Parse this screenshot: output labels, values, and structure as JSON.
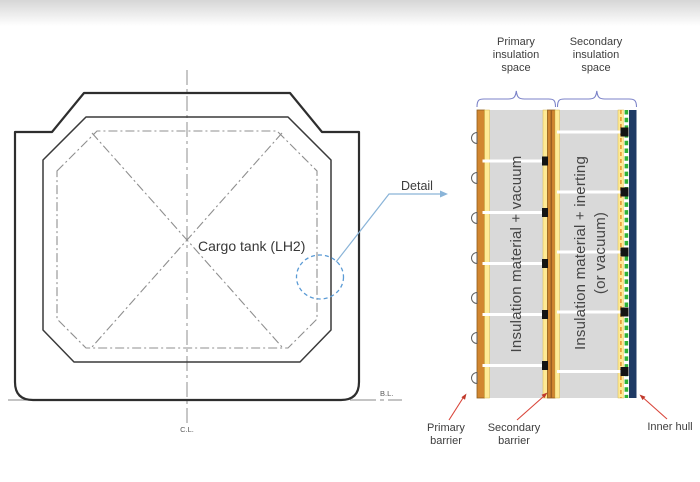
{
  "hull": {
    "tank_label": "Cargo tank (LH2)",
    "detail_label": "Detail",
    "centerline_label": "C.L.",
    "baseline_label": "B.L."
  },
  "detail": {
    "primary_space": {
      "lines": [
        "Primary",
        "insulation",
        "space"
      ]
    },
    "secondary_space": {
      "lines": [
        "Secondary",
        "insulation",
        "space"
      ]
    },
    "primary_fill_text": "Insulation material + vacuum",
    "secondary_fill_text_1": "Insulation material + inerting",
    "secondary_fill_text_2": "(or vacuum)",
    "primary_barrier": {
      "lines": [
        "Primary",
        "barrier"
      ]
    },
    "secondary_barrier": {
      "lines": [
        "Secondary",
        "barrier"
      ]
    },
    "inner_hull_label": "Inner hull"
  },
  "colors": {
    "insulation_gray": "#d9d9d9",
    "barrier_orange": "#d1862f",
    "barrier_yellow": "#ffea96",
    "barrier_dark_edge": "#8f5c1d",
    "inner_hull_navy": "#1e3a64",
    "membrane_green": "#2eb135",
    "membrane_orange_dash": "#e59a33",
    "callout_red": "#d9453a",
    "brace_blue": "#7b82c8",
    "leader_blue": "#8ab4d8",
    "detail_circle_blue": "#5b9bd5",
    "outline_dark": "#2e2e2e",
    "dash_gray": "#8f8f8f",
    "text_dark": "#3d3d3d"
  }
}
